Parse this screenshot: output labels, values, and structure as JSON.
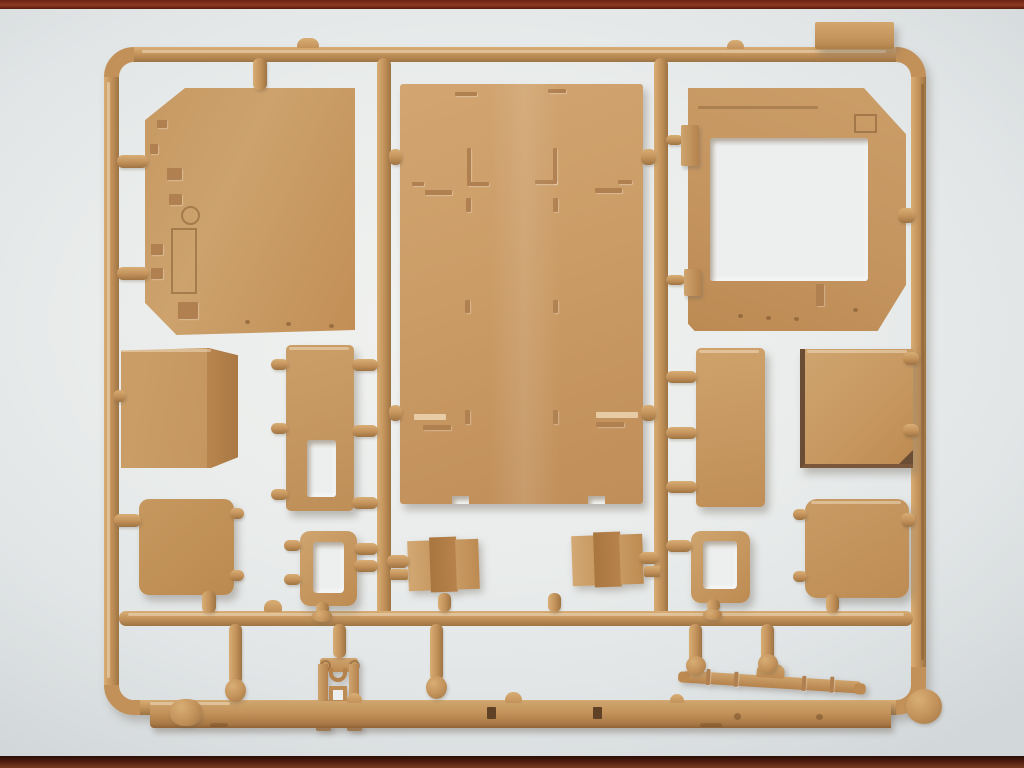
{
  "photo": {
    "subject": "tan injection-molded plastic model kit sprue lying on white paper, dark red-brown table edge visible at top and bottom",
    "visible_text": ""
  },
  "colors": {
    "table_top": "#8e3a22",
    "table_top_dark": "#5a1a0c",
    "table_bottom": "#4f1c0e",
    "table_bottom_light": "#7a3a22",
    "paper": "#f1f2f0",
    "paper_edge": "#d2d7d9",
    "sprue": "#c2915a",
    "sprue_light": "#d8ae75",
    "sprue_dark": "#9e7442",
    "part_light": "#d2a571",
    "part_mid": "#c79a63",
    "part_dark": "#b08050",
    "deep_shadow": "#6b4c34",
    "hole": "#edefee",
    "slot_dark": "#5f4226"
  },
  "parts": [
    {
      "id": "hull-side-panel",
      "desc": "large flat panel with chamfered left corners and small hatch details, top left"
    },
    {
      "id": "roof-floor-panel",
      "desc": "large rectangular panel with raised rib and angle details, center"
    },
    {
      "id": "cab-rear-panel",
      "desc": "panel with large square window opening, chamfered right corners, top right"
    },
    {
      "id": "sprue-label-tab",
      "desc": "blank molded manufacturer tab, top right corner"
    },
    {
      "id": "stowage-box",
      "desc": "angled box with darker side face, middle left"
    },
    {
      "id": "door-panel-slotted",
      "desc": "tall door panel with rectangular vision slot, middle left"
    },
    {
      "id": "hatch-panel-lower-left",
      "desc": "rounded-corner square hatch panel, lower left"
    },
    {
      "id": "window-frame-left",
      "desc": "small rectangular frame with open center"
    },
    {
      "id": "mud-flap-left",
      "desc": "folded three-facet flap, center"
    },
    {
      "id": "mud-flap-right",
      "desc": "folded three-facet flap, center right"
    },
    {
      "id": "window-frame-right",
      "desc": "small rectangular frame with open center, right"
    },
    {
      "id": "door-panel-plain",
      "desc": "tall plain door panel, middle right"
    },
    {
      "id": "stowage-box-right",
      "desc": "box with dark shaded left edge, middle right"
    },
    {
      "id": "hatch-panel-lower-right",
      "desc": "rounded-corner square hatch panel, lower right"
    },
    {
      "id": "towing-bracket",
      "desc": "bracket with eared top plate, U-clamp and square opening, bottom center"
    },
    {
      "id": "leaf-spring-axle",
      "desc": "axle with leaf springs and differential hump, bottom right"
    },
    {
      "id": "side-sill-strip",
      "desc": "long flat sill strip with two dark slots, along bottom runner"
    }
  ]
}
